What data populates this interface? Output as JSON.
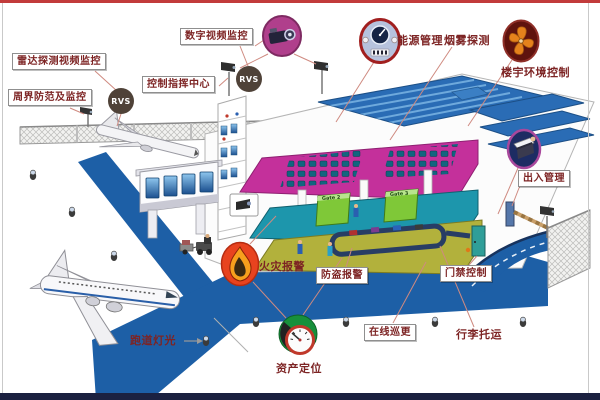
{
  "diagram": {
    "title": "airport integrated security systems diagram",
    "systems": {
      "radar_video": "雷达探测视频监控",
      "perimeter": "周界防范及监控",
      "digital_video": "数字视频监控",
      "control_center": "控制指挥中心",
      "energy": "能源管理",
      "smoke": "烟雾探测",
      "building_env": "楼宇环境控制",
      "entry_exit": "出入管理",
      "door_access": "门禁控制",
      "burglar_alarm": "防盗报警",
      "online_patrol": "在线巡更",
      "luggage": "行李托运",
      "runway_lights": "跑道灯光",
      "asset_location": "资产定位",
      "fire_alarm": "火灾报警"
    },
    "badges": {
      "rvs": "RVS"
    },
    "gates": {
      "g2": "Gate  2",
      "g3": "Gate  3"
    },
    "icons": {
      "digital_video": "camera-icon",
      "energy": "meter-gauge-icon",
      "building_env": "fan-icon",
      "entry_exit": "card-reader-icon",
      "fire_alarm": "flame-icon",
      "asset_location": "dial-gauge-icon",
      "rvs": "rvs-badge",
      "runway_light": "runway-light-icon",
      "cctv": "cctv-camera-icon"
    },
    "colors": {
      "label_text": "#7d2424",
      "label_border": "#8f8f8f",
      "runway": "#1d5fa6",
      "roof": "#2a6cb5",
      "floor_magenta": "#c4309b",
      "floor_teal": "#1d96ac",
      "floor_olive": "#b2b13c",
      "gate_green": "#7fc838",
      "top_bar": "#c23b3b",
      "bottom_bar": "#1b2140",
      "flame": "#e8431f",
      "fan": "#e5821c",
      "connector": "#cf8a80"
    }
  }
}
